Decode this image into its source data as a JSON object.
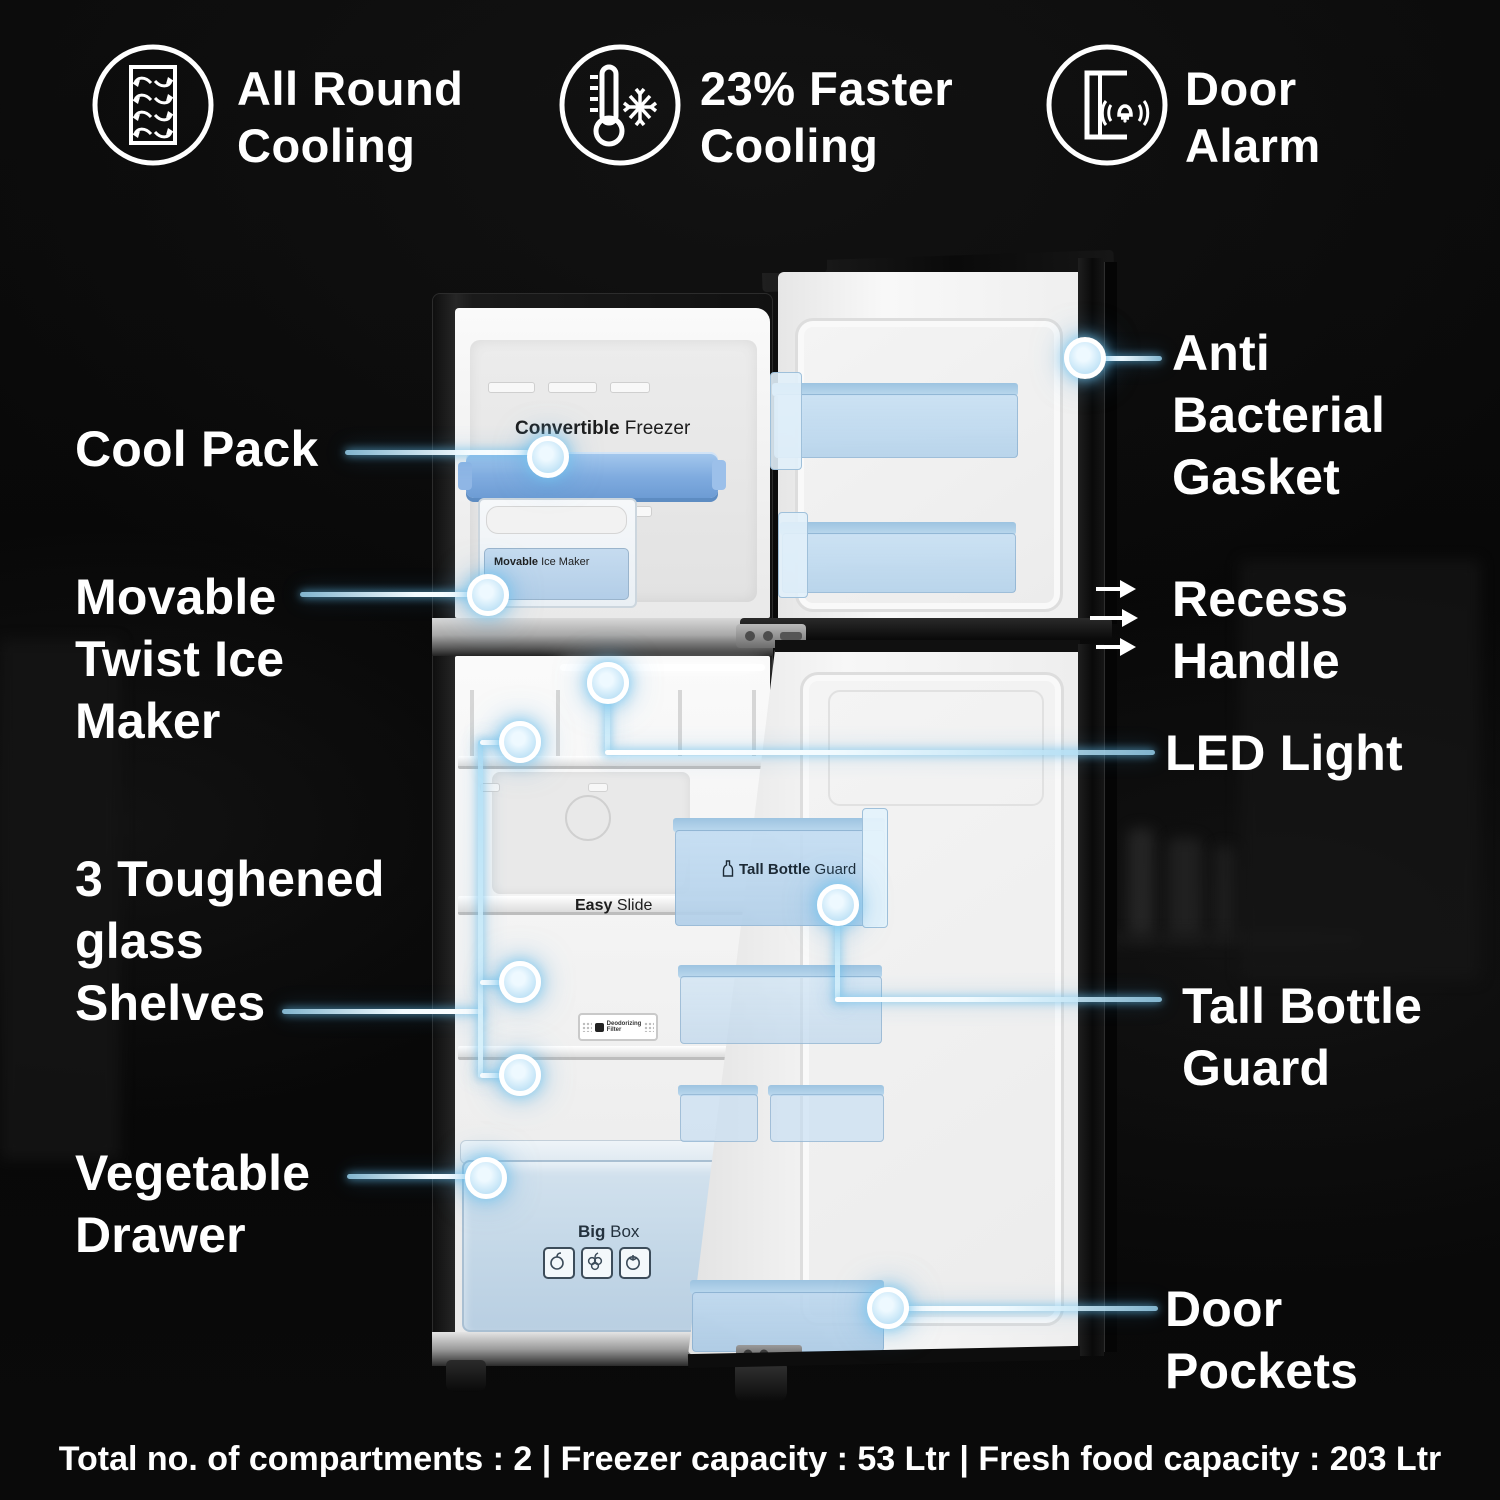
{
  "features": [
    {
      "icon": "all-round-cooling-icon",
      "line1": "All Round",
      "line2": "Cooling"
    },
    {
      "icon": "faster-cooling-icon",
      "line1": "23% Faster",
      "line2": "Cooling"
    },
    {
      "icon": "door-alarm-icon",
      "line1": "Door",
      "line2": "Alarm"
    }
  ],
  "callouts": {
    "cool_pack": {
      "line1": "Cool Pack"
    },
    "ice_maker": {
      "line1": "Movable",
      "line2": "Twist Ice",
      "line3": "Maker"
    },
    "shelves": {
      "line1": "3 Toughened",
      "line2": "glass",
      "line3": "Shelves"
    },
    "vegetable_drawer": {
      "line1": "Vegetable",
      "line2": "Drawer"
    },
    "gasket": {
      "line1": "Anti",
      "line2": "Bacterial",
      "line3": "Gasket"
    },
    "recess_handle": {
      "line1": "Recess",
      "line2": "Handle"
    },
    "led_light": {
      "line1": "LED Light"
    },
    "bottle_guard": {
      "line1": "Tall Bottle",
      "line2": "Guard"
    },
    "door_pockets": {
      "line1": "Door",
      "line2": "Pockets"
    }
  },
  "fridge_labels": {
    "freezer_bold": "Convertible",
    "freezer_reg": " Freezer",
    "ice_bold": "Movable",
    "ice_reg": " Ice Maker",
    "shelf_bold": "Easy",
    "shelf_reg": " Slide",
    "bottle_bold": "Tall Bottle",
    "bottle_reg": " Guard",
    "bigbox_bold": "Big",
    "bigbox_reg": " Box",
    "deodorizer_line1": "Deodorizing",
    "deodorizer_line2": "Filter"
  },
  "footer": {
    "text": "Total no. of compartments : 2 | Freezer capacity : 53 Ltr | Fresh food capacity : 203 Ltr"
  },
  "colors": {
    "accent_glow": "#6fc7ee",
    "line_core": "#e9f7ff",
    "bin_blue": "#c7def2",
    "cool_pack_blue": "#85b1e2"
  }
}
